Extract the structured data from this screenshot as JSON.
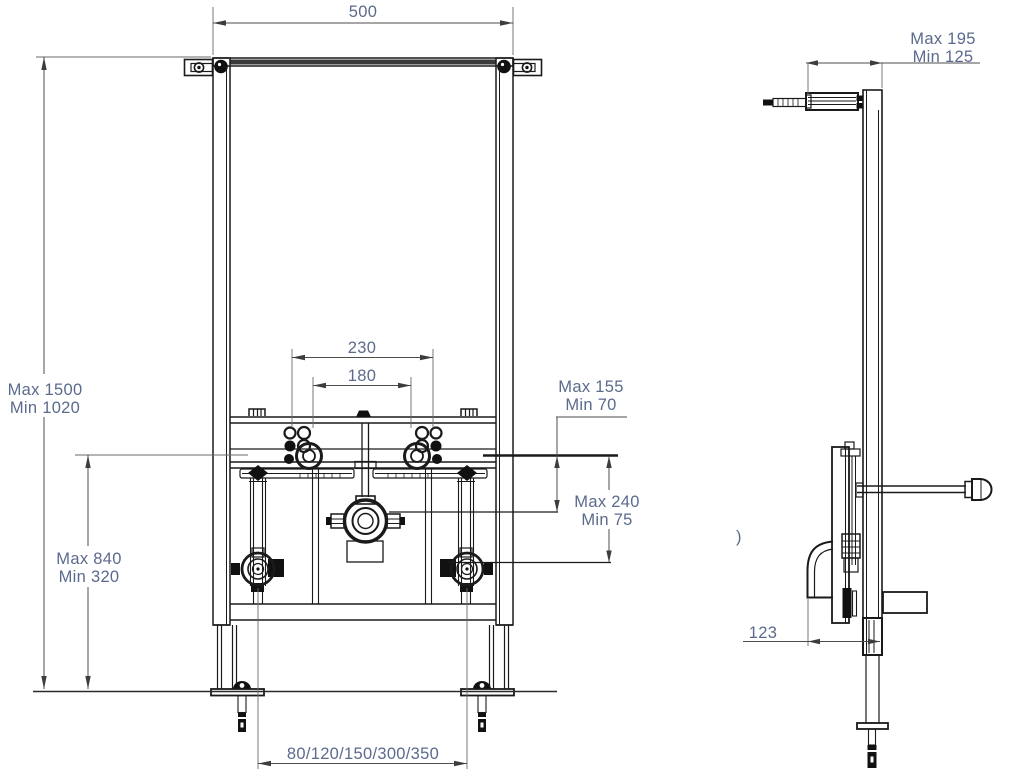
{
  "diagram_type": "installation-frame-technical-drawing",
  "colors": {
    "background": "#ffffff",
    "part_line": "#1a1a1a",
    "dimension_line": "#4d4d4d",
    "dimension_text": "#5b6a8d"
  },
  "labels": {
    "front": {
      "width_top": "500",
      "height_overall_max": "Max 1500",
      "height_overall_min": "Min 1020",
      "stud_spacing_outer": "230",
      "stud_spacing_inner": "180",
      "offset_top_max": "Max 155",
      "offset_top_min": "Min 70",
      "drain_offset_max": "Max 240",
      "drain_offset_min": "Min 75",
      "height_lower_max": "Max 840",
      "height_lower_min": "Min 320",
      "water_inlet_spacing": "80/120/150/300/350"
    },
    "side": {
      "depth_max": "Max 195",
      "depth_min": "Min 125",
      "frame_depth": "123",
      "stray_mark": ")"
    }
  }
}
